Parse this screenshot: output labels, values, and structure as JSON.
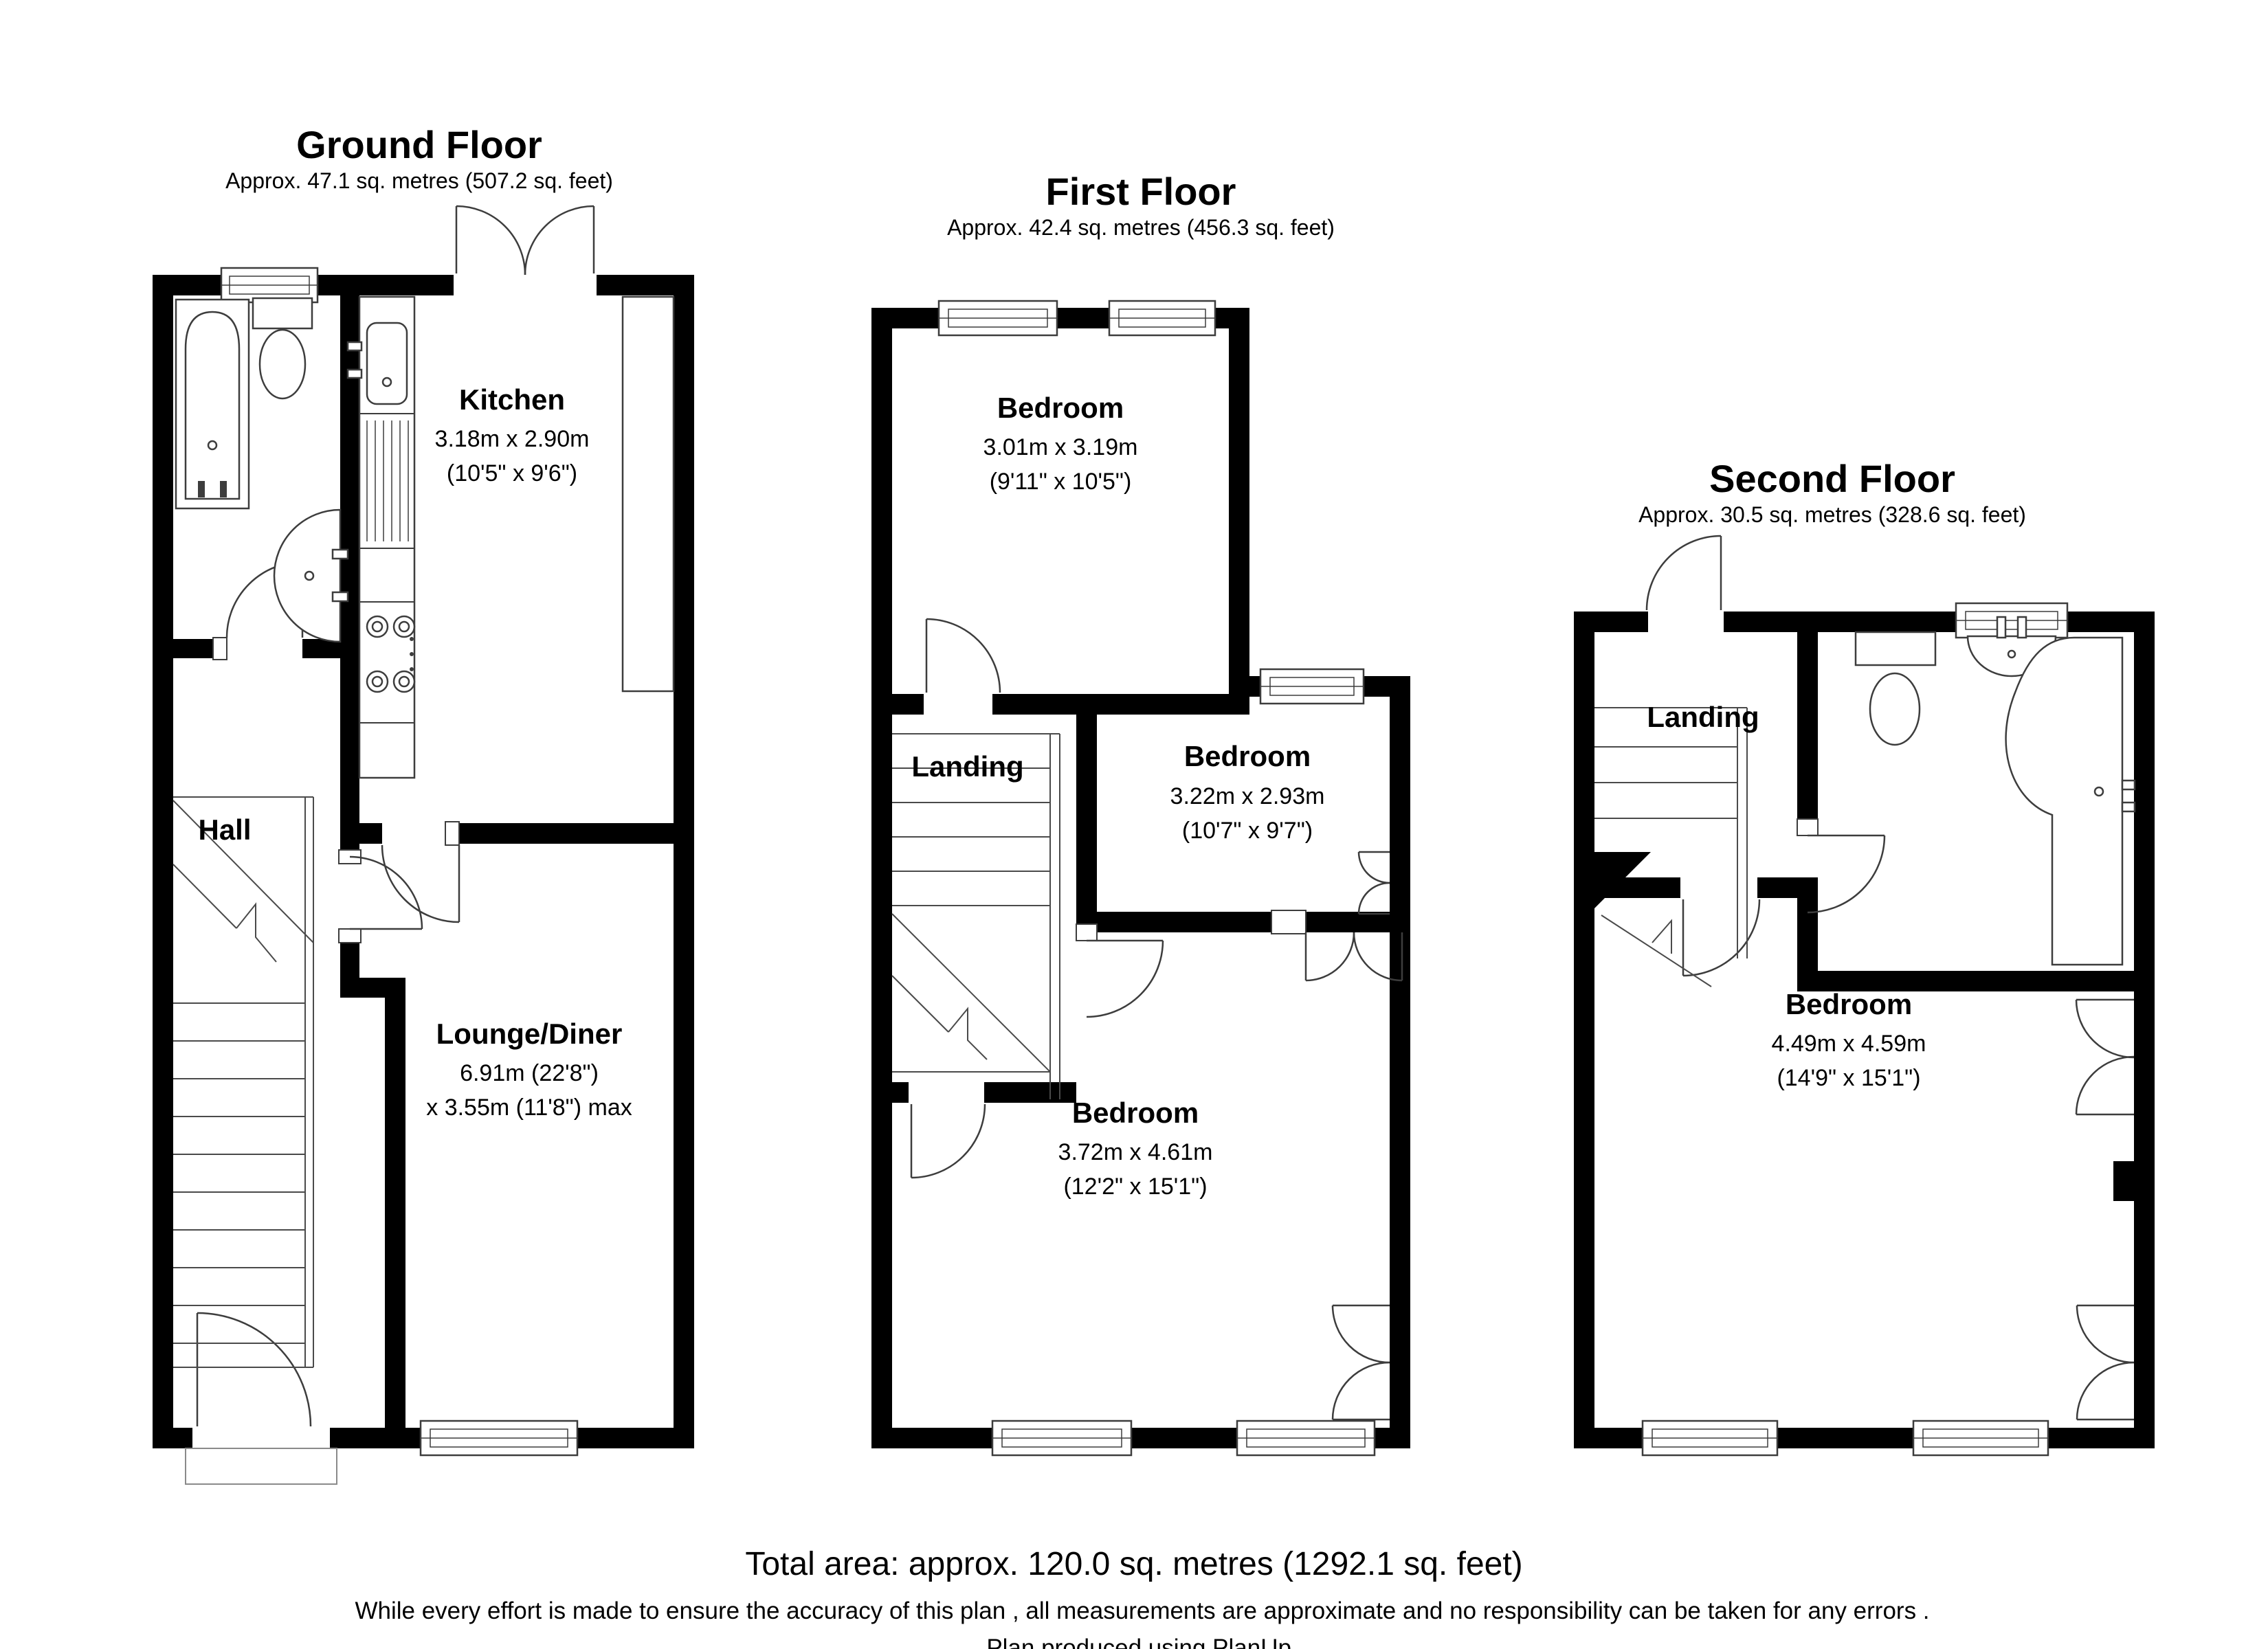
{
  "colors": {
    "wall": "#000000",
    "fixture_line": "#3d3d3d",
    "stair_line": "#4a4a4a",
    "text": "#000000",
    "background": "#ffffff"
  },
  "floors": [
    {
      "title": "Ground Floor",
      "subtitle": "Approx. 47.1 sq. metres (507.2 sq. feet)",
      "rooms": {
        "kitchen": {
          "name": "Kitchen",
          "dims_metric": "3.18m x 2.90m",
          "dims_imperial": "(10'5\" x 9'6\")"
        },
        "hall": {
          "name": "Hall"
        },
        "lounge": {
          "name": "Lounge/Diner",
          "dims_metric": "6.91m (22'8\")",
          "dims_imperial": "x 3.55m (11'8\") max"
        }
      }
    },
    {
      "title": "First Floor",
      "subtitle": "Approx. 42.4 sq. metres (456.3 sq. feet)",
      "rooms": {
        "bedroom_front": {
          "name": "Bedroom",
          "dims_metric": "3.01m x 3.19m",
          "dims_imperial": "(9'11\" x 10'5\")"
        },
        "landing": {
          "name": "Landing"
        },
        "bedroom_middle": {
          "name": "Bedroom",
          "dims_metric": "3.22m x 2.93m",
          "dims_imperial": "(10'7\" x 9'7\")"
        },
        "bedroom_rear": {
          "name": "Bedroom",
          "dims_metric": "3.72m x 4.61m",
          "dims_imperial": "(12'2\" x 15'1\")"
        }
      }
    },
    {
      "title": "Second Floor",
      "subtitle": "Approx. 30.5 sq. metres (328.6 sq. feet)",
      "rooms": {
        "landing": {
          "name": "Landing"
        },
        "bedroom": {
          "name": "Bedroom",
          "dims_metric": "4.49m x 4.59m",
          "dims_imperial": "(14'9\" x 15'1\")"
        }
      }
    }
  ],
  "footer": {
    "total_area": "Total area: approx. 120.0 sq. metres (1292.1 sq. feet)",
    "disclaimer_line1": "While every effort is made to ensure the accuracy of this plan , all measurements are approximate and no responsibility can be taken for any errors .",
    "disclaimer_line2": "Plan produced using PlanUp."
  }
}
